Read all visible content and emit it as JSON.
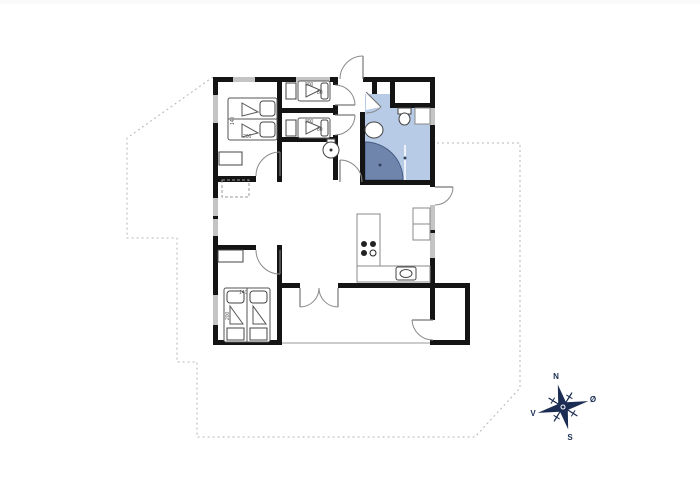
{
  "compass": {
    "north": "N",
    "east": "Ø",
    "south": "S",
    "west": "V"
  },
  "beds": {
    "master_double": {
      "width_label": "140",
      "length_label": "200"
    },
    "single_top": {
      "width_label": "80",
      "length_label": "200"
    },
    "single_mid": {
      "width_label": "80",
      "length_label": "200"
    },
    "second_double": {
      "width_label": "140",
      "length_label": "200"
    }
  },
  "colors": {
    "wall": "#141414",
    "window": "#c4c4c4",
    "bathroom_fill": "#b7cae6",
    "shower_fill": "#7085ac",
    "shower_border": "#455a82",
    "compass_navy": "#1b2d52",
    "dotted_outline": "#b5b5b5"
  }
}
